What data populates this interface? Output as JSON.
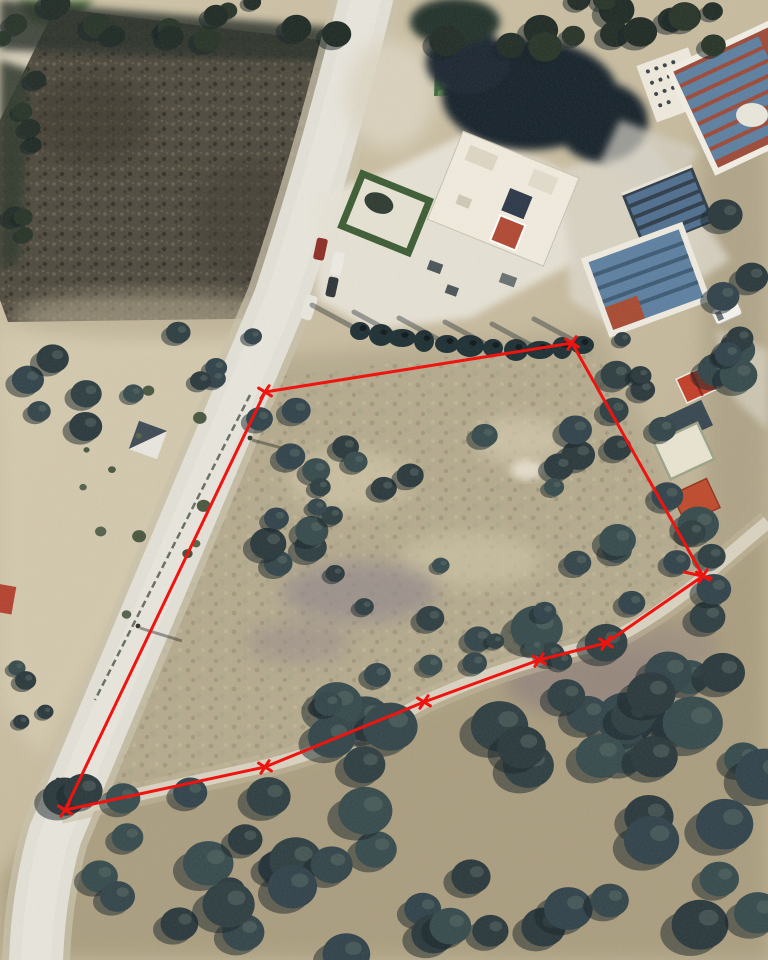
{
  "page": {
    "title": "Aerial satellite photograph of a land parcel outlined with a red boundary"
  },
  "image": {
    "width": 768,
    "height": 960,
    "kind": "satellite aerial photo",
    "annotation": "red surveyed parcel boundary polygon with vertex tick markers"
  },
  "boundary": {
    "color": "#ef1410",
    "stroke_width": 3,
    "marker_size": 15,
    "vertices": [
      [
        265,
        392
      ],
      [
        572,
        343
      ],
      [
        703,
        576
      ],
      [
        606,
        643
      ],
      [
        539,
        660
      ],
      [
        424,
        702
      ],
      [
        265,
        767
      ],
      [
        65,
        810
      ]
    ],
    "end_bar": [
      684,
      572,
      711,
      578
    ]
  },
  "landmarks": {
    "main_road_color": "#e3e0d6",
    "dirt_track_color": "#d9d2c0",
    "scrub_field_color": "#4f4a3e",
    "olive_tree_color": "#2f3f41",
    "solar_panel_color": "#5d7fa0",
    "red_roof_color": "#b04832",
    "lawn_color": "#45703f",
    "white_building_color": "#f0ebdd"
  }
}
